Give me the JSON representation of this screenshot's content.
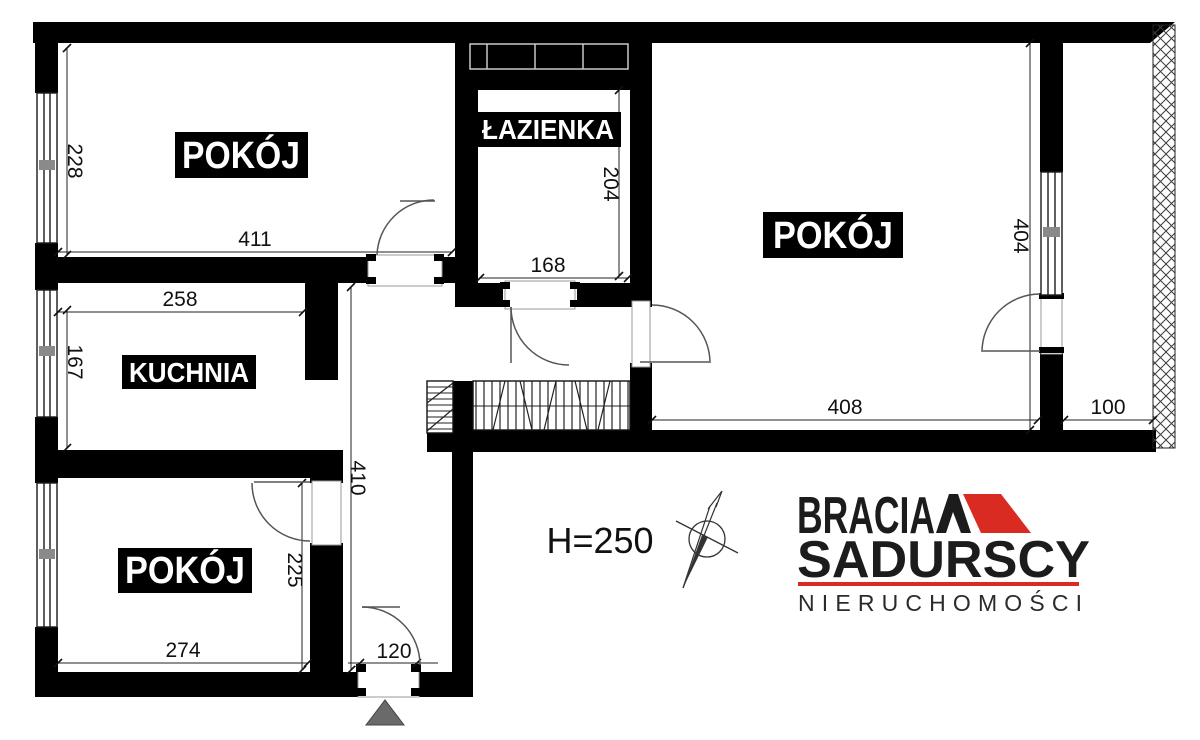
{
  "rooms": {
    "room_top_left": "POKÓJ",
    "bathroom": "ŁAZIENKA",
    "room_right": "POKÓJ",
    "kitchen": "KUCHNIA",
    "room_bottom_left": "POKÓJ"
  },
  "dimensions": {
    "room_top_left_height": "228",
    "room_top_left_width": "411",
    "kitchen_width": "258",
    "kitchen_height": "167",
    "bathroom_height": "204",
    "bathroom_width": "168",
    "room_right_height": "404",
    "room_right_width": "408",
    "balcony_depth": "100",
    "hallway_length": "410",
    "room_bottom_left_height": "225",
    "room_bottom_left_width": "274",
    "entrance_width": "120"
  },
  "annotations": {
    "ceiling_height": "H=250"
  },
  "branding": {
    "line1": "BRACIA",
    "line2": "SADURSCY",
    "line3": "NIERUCHOMOŚCI"
  },
  "colors": {
    "wall": "#000000",
    "brand_red": "#da2b23",
    "entrance_marker_gray": "#6a6a6a"
  }
}
